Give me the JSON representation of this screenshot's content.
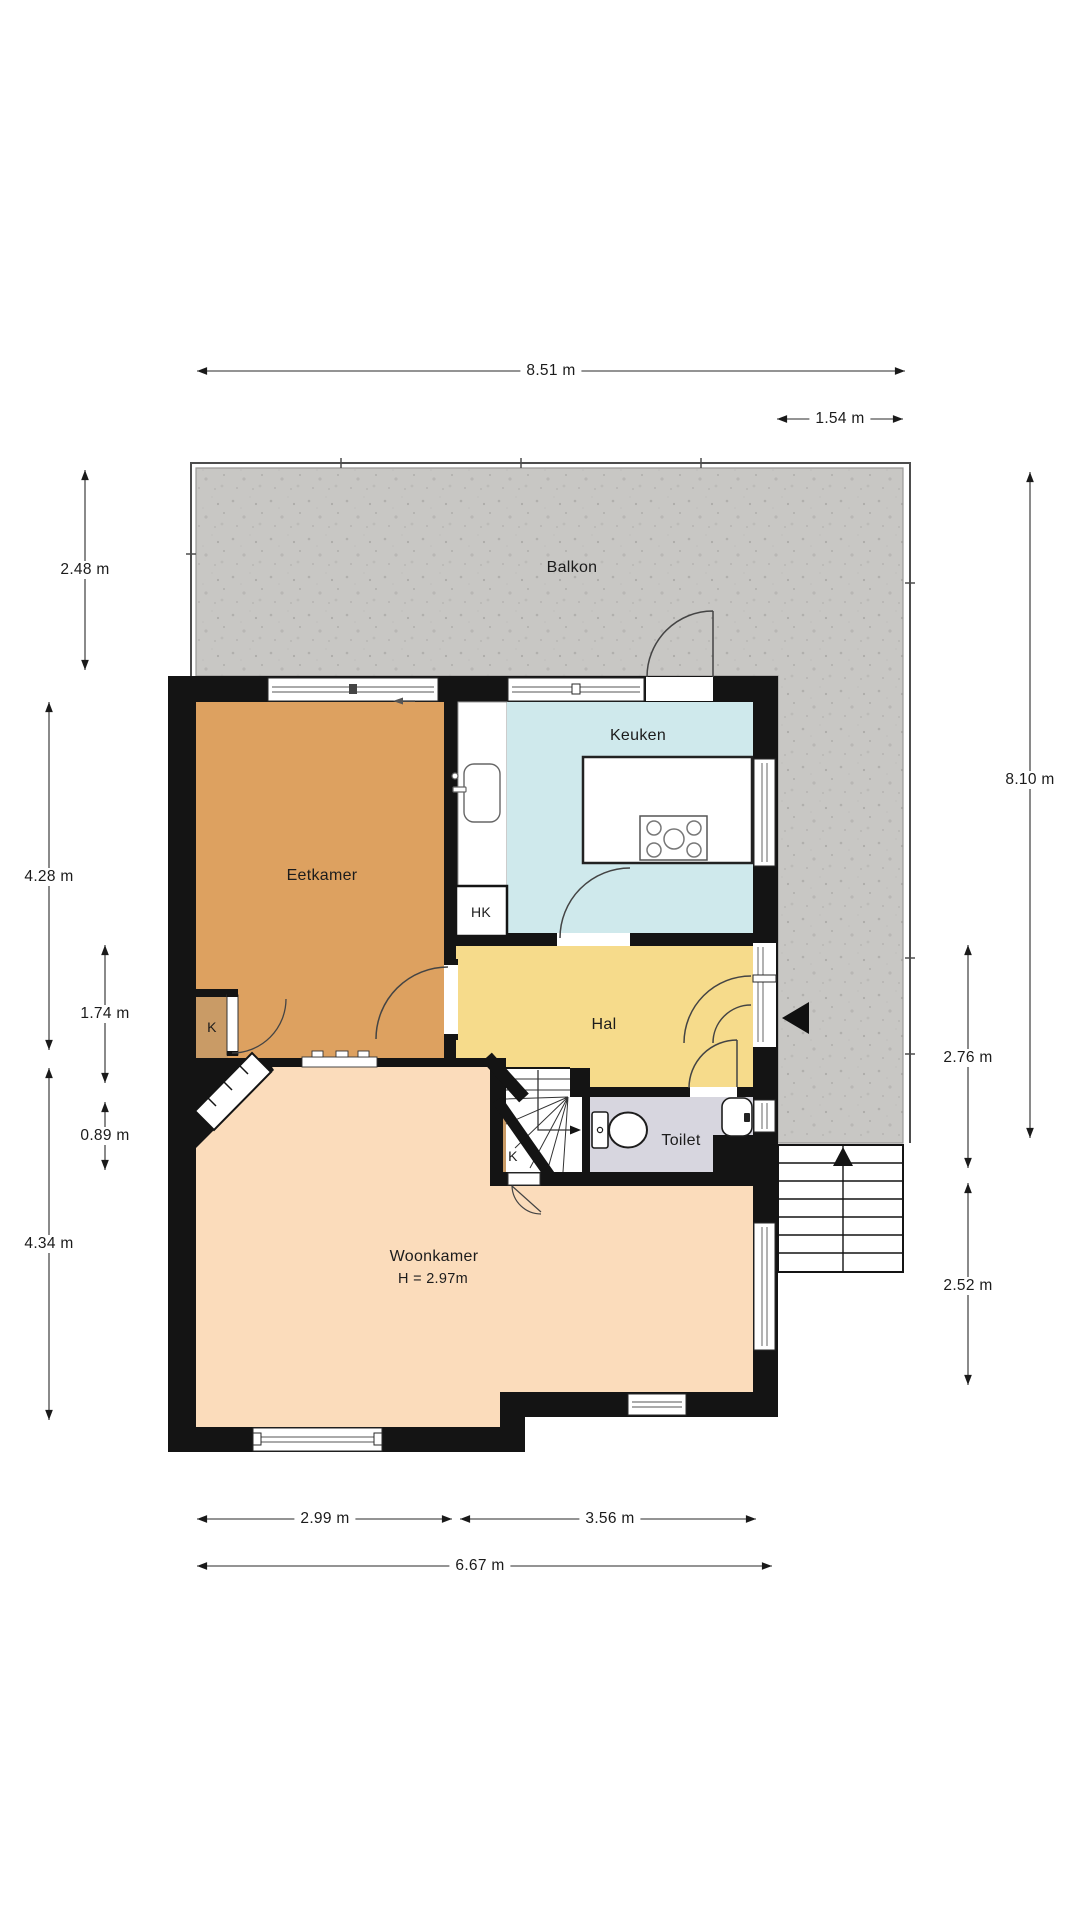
{
  "plan_title": "Begane grond plattegrond",
  "rooms": {
    "balkon": {
      "label": "Balkon"
    },
    "keuken": {
      "label": "Keuken"
    },
    "eetkamer": {
      "label": "Eetkamer"
    },
    "hal": {
      "label": "Hal"
    },
    "toilet": {
      "label": "Toilet"
    },
    "woonkamer": {
      "label": "Woonkamer",
      "height_note": "H = 2.97m"
    },
    "closet_hk": {
      "label": "HK"
    },
    "closet_k_eetkamer": {
      "label": "K"
    },
    "closet_k_stairs": {
      "label": "K"
    }
  },
  "dimensions": {
    "top_total": "8.51 m",
    "top_right": "1.54 m",
    "left_balkon": "2.48 m",
    "left_eetkamer": "4.28 m",
    "left_hal": "1.74 m",
    "left_toilet": "0.89 m",
    "left_woonkamer": "4.34 m",
    "right_total": "8.10 m",
    "right_entry": "2.76 m",
    "right_stairs": "2.52 m",
    "bottom_left": "2.99 m",
    "bottom_right": "3.56 m",
    "bottom_total": "6.67 m"
  },
  "colors": {
    "wall": "#141414",
    "balkon": "#c8c7c4",
    "keuken": "#cfe9ec",
    "eetkamer": "#dda160",
    "hal": "#f6db8b",
    "toilet": "#d7d6df",
    "woonkamer": "#fbdcbb",
    "closet": "#c99b66",
    "dim_text": "#1b1b1b"
  }
}
